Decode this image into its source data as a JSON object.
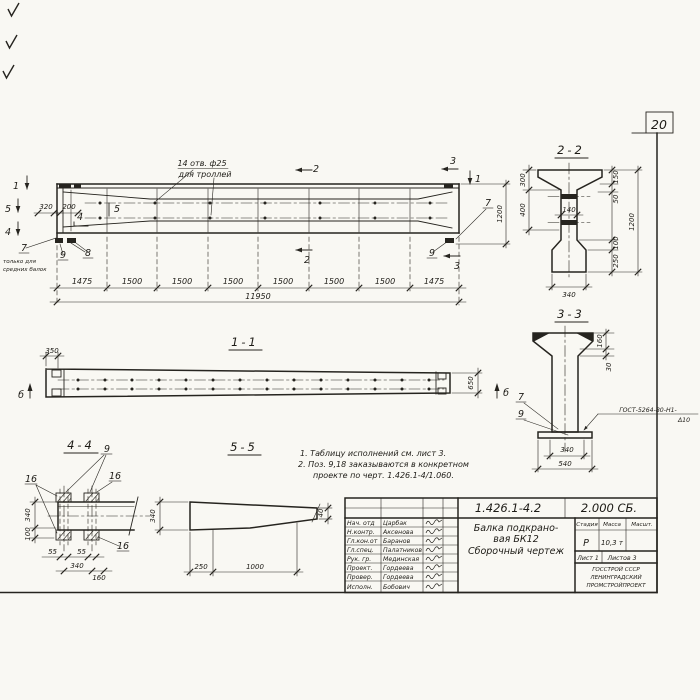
{
  "sheet": {
    "page_number": "20",
    "doc_number": "1.426.1-4.2",
    "doc_code": "2.000 СБ.",
    "product_line1": "Балка подкрано-",
    "product_line2": "вая БК12",
    "product_line3": "Сборочный чертеж",
    "col_stage": "Стадия",
    "col_mass": "Масса",
    "col_scale": "Масшт.",
    "stage_value": "Р",
    "mass_value": "10,3 т",
    "sheet_no": "Лист 1",
    "sheets_total": "Листов 3",
    "org1": "ГОССТРОЙ СССР",
    "org2": "ЛЕНИНГРАДСКИЙ",
    "org3": "ПРОМСТРОЙПРОЕКТ",
    "signatures": [
      {
        "role": "Нач. отд",
        "name": "Царбак"
      },
      {
        "role": "Н.контр.",
        "name": "Аксенова"
      },
      {
        "role": "Гл.кон.от",
        "name": "Баранов"
      },
      {
        "role": "Гл.спец.",
        "name": "Палатников"
      },
      {
        "role": "Рук. гр.",
        "name": "Мединская"
      },
      {
        "role": "Проект.",
        "name": "Гордеева"
      },
      {
        "role": "Провер.",
        "name": "Гордеева"
      },
      {
        "role": "Исполн.",
        "name": "Бобович"
      }
    ]
  },
  "notes": {
    "n1": "1. Таблицу исполнений  см. лист 3.",
    "n2": "2. Поз. 9,18 заказываются в конкретном",
    "n3": "проекте по черт. 1.426.1-4/1.060."
  },
  "main_view": {
    "hole_note1": "14 отв. ф25",
    "hole_note2": "для троллей",
    "only1": "только для",
    "only2": "средних балок",
    "d320": "320",
    "d200": "200",
    "d1200": "1200",
    "total": "11950",
    "chain": [
      "1475",
      "1500",
      "1500",
      "1500",
      "1500",
      "1500",
      "1500",
      "1475"
    ],
    "mk1l": "1",
    "mk1r": "1",
    "mk2t": "2",
    "mk2b": "2",
    "mk3t": "3",
    "mk3b": "3",
    "mk4": "4",
    "mk5": "5",
    "c4": "4",
    "c5": "5",
    "c7l": "7",
    "c7r": "7",
    "c8": "8",
    "c9l": "9",
    "c9r": "9"
  },
  "section22": {
    "title": "2-2",
    "d300": "300",
    "d400": "400",
    "d140": "140",
    "d150": "150",
    "d50": "50",
    "d100": "100",
    "d250": "250",
    "d1200": "1200",
    "d340": "340"
  },
  "view11": {
    "title": "1-1",
    "d350": "350",
    "d650": "650",
    "mbl": "б",
    "mbr": "б"
  },
  "section33": {
    "title": "3-3",
    "d160": "160",
    "d30": "30",
    "d340": "340",
    "d540": "540",
    "c7": "7",
    "c9": "9",
    "weld1": "ГОСТ-5264-80-Н1-",
    "weld2": "Δ10"
  },
  "detail44": {
    "title": "4-4",
    "d340l": "340",
    "d100": "100",
    "d55a": "55",
    "d55b": "55",
    "d340b": "340",
    "d160": "160",
    "c9": "9",
    "c16a": "16",
    "c16b": "16",
    "c16c": "16"
  },
  "detail55": {
    "title": "5-5",
    "d340": "340",
    "d40": "40",
    "d250": "250",
    "d1000": "1000"
  }
}
